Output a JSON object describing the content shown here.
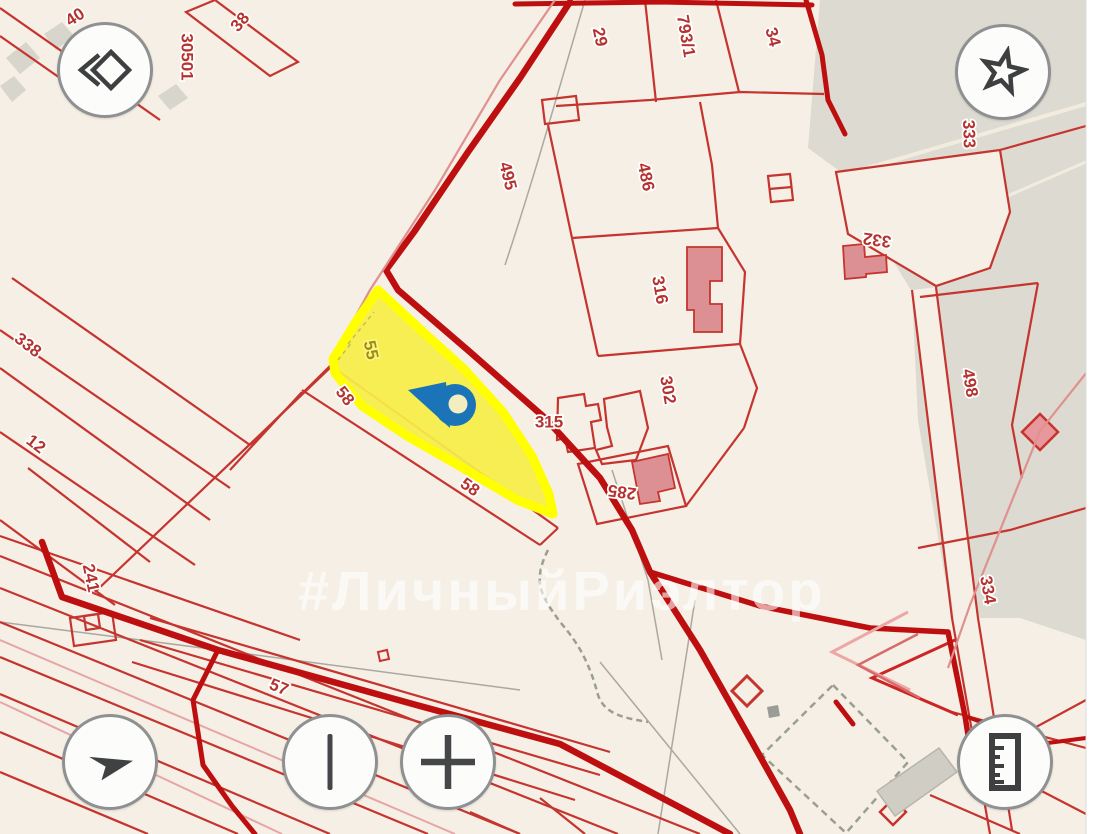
{
  "map": {
    "watermark": "#ЛичныйРиэлтор",
    "marker": {
      "type": "location-pin",
      "color": "#1b74b8"
    },
    "highlight": {
      "parcel": "55",
      "fill": "#f6ee48",
      "border": "#ffff00"
    },
    "colors": {
      "background": "#f5efe5",
      "grey_zone": "#dcdad1",
      "parcel_line": "#c5342e",
      "road": "#bd0f0f",
      "building_fill": "#dd9094",
      "label_red": "#b5322f",
      "label_olive": "#9c8b25",
      "pin_blue": "#1b74b8"
    },
    "parcel_labels": [
      {
        "text": "40",
        "x": 75,
        "y": 17,
        "rot": -33
      },
      {
        "text": "30501",
        "x": 187,
        "y": 57,
        "rot": 90,
        "size": 21
      },
      {
        "text": "38",
        "x": 240,
        "y": 22,
        "rot": -50
      },
      {
        "text": "29",
        "x": 600,
        "y": 37,
        "rot": 78
      },
      {
        "text": "793/1",
        "x": 686,
        "y": 36,
        "rot": 80
      },
      {
        "text": "34",
        "x": 773,
        "y": 37,
        "rot": 75
      },
      {
        "text": "333",
        "x": 969,
        "y": 134,
        "rot": 88
      },
      {
        "text": "495",
        "x": 508,
        "y": 176,
        "rot": 76
      },
      {
        "text": "486",
        "x": 646,
        "y": 177,
        "rot": 78
      },
      {
        "text": "332",
        "x": 877,
        "y": 240,
        "rot": 188
      },
      {
        "text": "316",
        "x": 660,
        "y": 290,
        "rot": 80
      },
      {
        "text": "302",
        "x": 668,
        "y": 390,
        "rot": 80
      },
      {
        "text": "498",
        "x": 970,
        "y": 383,
        "rot": 80
      },
      {
        "text": "338",
        "x": 28,
        "y": 345,
        "rot": 38
      },
      {
        "text": "12",
        "x": 36,
        "y": 444,
        "rot": 38
      },
      {
        "text": "241",
        "x": 91,
        "y": 578,
        "rot": 78
      },
      {
        "text": "55",
        "x": 371,
        "y": 350,
        "rot": 78,
        "size": 19,
        "color": "olive"
      },
      {
        "text": "58",
        "x": 345,
        "y": 396,
        "rot": 52
      },
      {
        "text": "315",
        "x": 549,
        "y": 422,
        "rot": 0
      },
      {
        "text": "58",
        "x": 470,
        "y": 487,
        "rot": 35
      },
      {
        "text": "285",
        "x": 622,
        "y": 492,
        "rot": 188
      },
      {
        "text": "334",
        "x": 988,
        "y": 590,
        "rot": 80
      },
      {
        "text": "57",
        "x": 279,
        "y": 687,
        "rot": 22
      }
    ]
  },
  "controls": {
    "buttons": [
      {
        "name": "map-style-button",
        "icon": "diamond-chevron-icon"
      },
      {
        "name": "favorites-button",
        "icon": "star-icon"
      },
      {
        "name": "compass-button",
        "icon": "compass-arrow-icon"
      },
      {
        "name": "zoom-out-button",
        "icon": "vertical-bar-icon"
      },
      {
        "name": "zoom-in-button",
        "icon": "plus-icon"
      },
      {
        "name": "measure-button",
        "icon": "ruler-icon"
      }
    ]
  }
}
